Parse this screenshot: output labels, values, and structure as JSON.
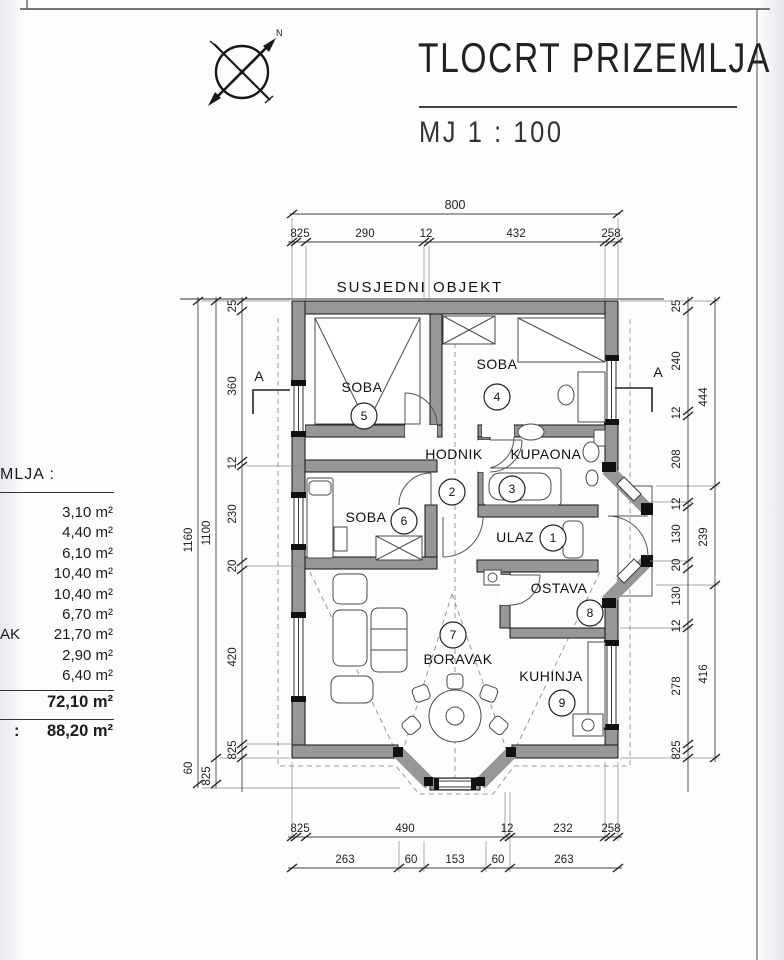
{
  "title_block": {
    "title": "TLOCRT PRIZEMLJA",
    "scale": "MJ 1 : 100"
  },
  "sheet": {
    "compass_north": "N"
  },
  "plan": {
    "neighbor_label": "SUSJEDNI OBJEKT",
    "section_letter": "A"
  },
  "rooms": {
    "ulaz": {
      "name": "ULAZ",
      "num": "1"
    },
    "hodnik": {
      "name": "HODNIK",
      "num": "2"
    },
    "kupaona": {
      "name": "KUPAONA",
      "num": "3"
    },
    "soba4": {
      "name": "SOBA",
      "num": "4"
    },
    "soba5": {
      "name": "SOBA",
      "num": "5"
    },
    "soba6": {
      "name": "SOBA",
      "num": "6"
    },
    "boravak": {
      "name": "BORAVAK",
      "num": "7"
    },
    "ostava": {
      "name": "OSTAVA",
      "num": "8"
    },
    "kuhinja": {
      "name": "KUHINJA",
      "num": "9"
    }
  },
  "dims": {
    "top_total": "800",
    "top_chain": [
      "825",
      "290",
      "12",
      "432",
      "258"
    ],
    "bottom_chain": [
      "825",
      "490",
      "12",
      "232",
      "258"
    ],
    "bottom_chain2": [
      "263",
      "60",
      "153",
      "60",
      "263"
    ],
    "left_outer": {
      "total": "1160",
      "inner": "1100",
      "bay": "60",
      "bay2": "825"
    },
    "left_chain": [
      "25",
      "360",
      "12",
      "230",
      "20",
      "420",
      "825"
    ],
    "right_chain": [
      "25",
      "240",
      "12",
      "208",
      "12",
      "130",
      "20",
      "130",
      "12",
      "278",
      "825"
    ],
    "right_outer": [
      "444",
      "239",
      "416"
    ]
  },
  "area_table": {
    "header_fragment": "MLJA :",
    "row_labels": [
      "",
      "",
      "",
      "",
      "",
      "",
      "AK",
      "",
      ""
    ],
    "values": [
      "3,10 m²",
      "4,40 m²",
      "6,10 m²",
      "10,40 m²",
      "10,40 m²",
      "6,70 m²",
      "21,70 m²",
      "2,90 m²",
      "6,40 m²"
    ],
    "subtotal": "72,10 m²",
    "total_prefix": ":",
    "total": "88,20 m²"
  }
}
